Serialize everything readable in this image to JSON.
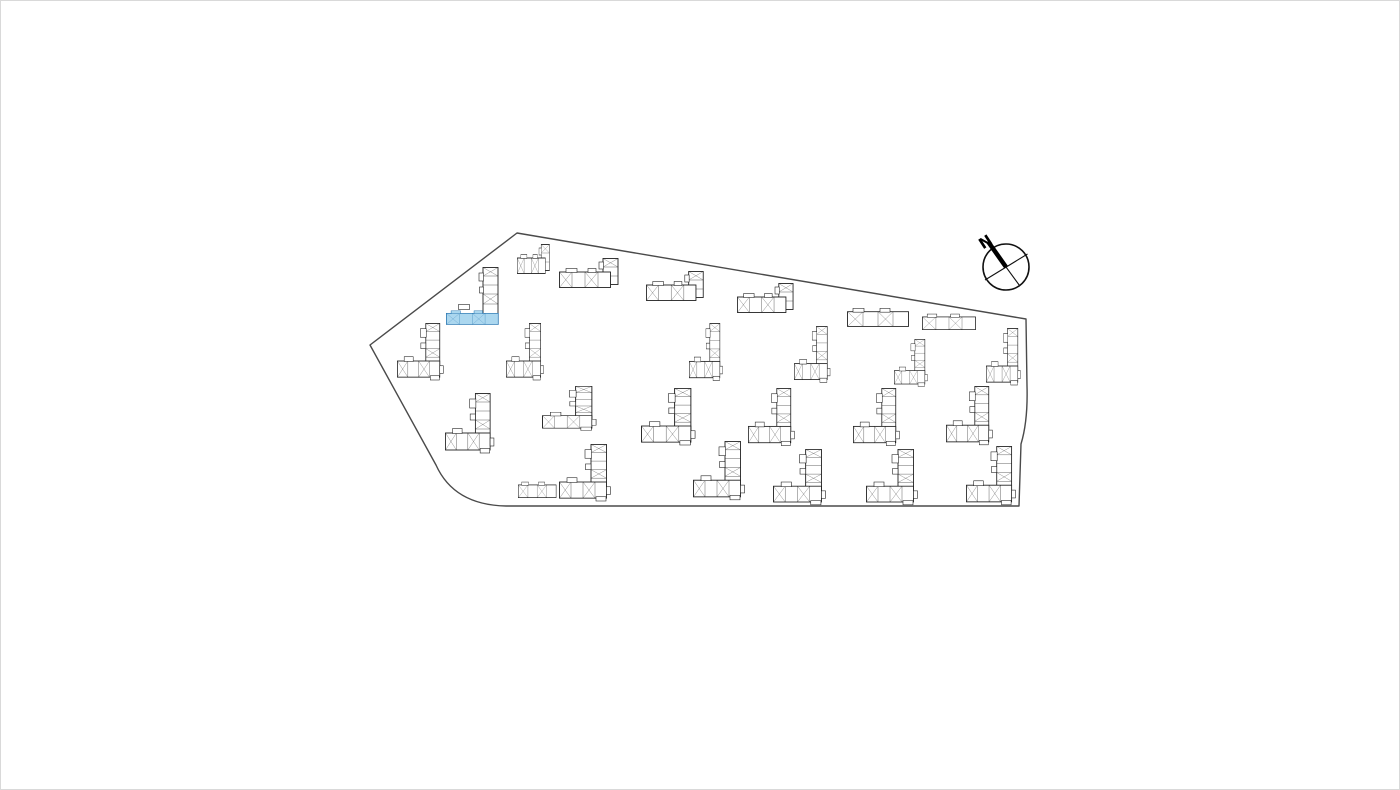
{
  "page": {
    "background": "#ffffff",
    "frame_border": "#d9d9d9"
  },
  "site": {
    "boundary_path": "M 516,232 L 1025,318 L 1026,385 Q 1027,420 1020,443 L 1018,505 L 505,505 Q 453,504 435,464 L 369,344 Z",
    "boundary_color": "#4a4a4a"
  },
  "compass": {
    "label": "N"
  },
  "colors": {
    "building_fill": "#ffffff",
    "building_stroke": "#222222",
    "highlight_fill": "#abd7ef",
    "highlight_stroke": "#2472ae"
  },
  "buildings": [
    {
      "id": "b01",
      "type": "barTower",
      "x": 516,
      "y": 243,
      "sx": 0.55,
      "sy": 1.0,
      "highlight": false
    },
    {
      "id": "b02",
      "type": "barTower",
      "x": 558,
      "y": 257,
      "sx": 1.0,
      "sy": 1.0,
      "highlight": false
    },
    {
      "id": "b03",
      "type": "barTower",
      "x": 645,
      "y": 270,
      "sx": 0.97,
      "sy": 1.0,
      "highlight": false
    },
    {
      "id": "b04",
      "type": "barTower",
      "x": 736,
      "y": 282,
      "sx": 0.95,
      "sy": 1.0,
      "highlight": false
    },
    {
      "id": "b05",
      "type": "bar",
      "x": 846,
      "y": 305,
      "sx": 1.0,
      "sy": 0.95,
      "highlight": false
    },
    {
      "id": "b06",
      "type": "bar",
      "x": 921,
      "y": 311,
      "sx": 0.87,
      "sy": 0.82,
      "highlight": false
    },
    {
      "id": "b07",
      "type": "vbar",
      "x": 478,
      "y": 266,
      "sx": 1.0,
      "sy": 1.0,
      "highlight": false
    },
    {
      "id": "b08",
      "type": "bump",
      "x": 457,
      "y": 303,
      "sx": 1.0,
      "sy": 1.0,
      "highlight": false
    },
    {
      "id": "b09",
      "type": "bar",
      "x": 445,
      "y": 308,
      "sx": 0.85,
      "sy": 0.72,
      "highlight": true
    },
    {
      "id": "b10",
      "type": "L",
      "x": 396,
      "y": 322,
      "sx": 0.9,
      "sy": 0.95,
      "highlight": false
    },
    {
      "id": "b11",
      "type": "L",
      "x": 505,
      "y": 322,
      "sx": 0.73,
      "sy": 0.95,
      "highlight": false
    },
    {
      "id": "b12",
      "type": "L",
      "x": 688,
      "y": 322,
      "sx": 0.65,
      "sy": 0.96,
      "highlight": false
    },
    {
      "id": "b13",
      "type": "L",
      "x": 793,
      "y": 325,
      "sx": 0.7,
      "sy": 0.94,
      "highlight": false
    },
    {
      "id": "b14",
      "type": "L",
      "x": 893,
      "y": 338,
      "sx": 0.65,
      "sy": 0.79,
      "highlight": false
    },
    {
      "id": "b15",
      "type": "L",
      "x": 985,
      "y": 327,
      "sx": 0.67,
      "sy": 0.95,
      "highlight": false
    },
    {
      "id": "b16",
      "type": "L",
      "x": 444,
      "y": 392,
      "sx": 0.95,
      "sy": 1.0,
      "highlight": false
    },
    {
      "id": "b17",
      "type": "L",
      "x": 541,
      "y": 385,
      "sx": 1.05,
      "sy": 0.74,
      "highlight": false
    },
    {
      "id": "b18",
      "type": "L",
      "x": 640,
      "y": 387,
      "sx": 1.05,
      "sy": 0.95,
      "highlight": false
    },
    {
      "id": "b19",
      "type": "L",
      "x": 747,
      "y": 387,
      "sx": 0.9,
      "sy": 0.96,
      "highlight": false
    },
    {
      "id": "b20",
      "type": "L",
      "x": 852,
      "y": 387,
      "sx": 0.9,
      "sy": 0.96,
      "highlight": false
    },
    {
      "id": "b21",
      "type": "L",
      "x": 945,
      "y": 385,
      "sx": 0.9,
      "sy": 0.98,
      "highlight": false
    },
    {
      "id": "b22",
      "type": "bar",
      "x": 517,
      "y": 479,
      "sx": 0.62,
      "sy": 0.82,
      "highlight": false
    },
    {
      "id": "b23",
      "type": "L",
      "x": 558,
      "y": 443,
      "sx": 1.0,
      "sy": 0.95,
      "highlight": false
    },
    {
      "id": "b24",
      "type": "L",
      "x": 692,
      "y": 440,
      "sx": 1.0,
      "sy": 0.98,
      "highlight": false
    },
    {
      "id": "b25",
      "type": "L",
      "x": 772,
      "y": 448,
      "sx": 1.02,
      "sy": 0.93,
      "highlight": false
    },
    {
      "id": "b26",
      "type": "L",
      "x": 865,
      "y": 448,
      "sx": 1.0,
      "sy": 0.93,
      "highlight": false
    },
    {
      "id": "b27",
      "type": "L",
      "x": 965,
      "y": 445,
      "sx": 0.96,
      "sy": 0.98,
      "highlight": false
    }
  ]
}
